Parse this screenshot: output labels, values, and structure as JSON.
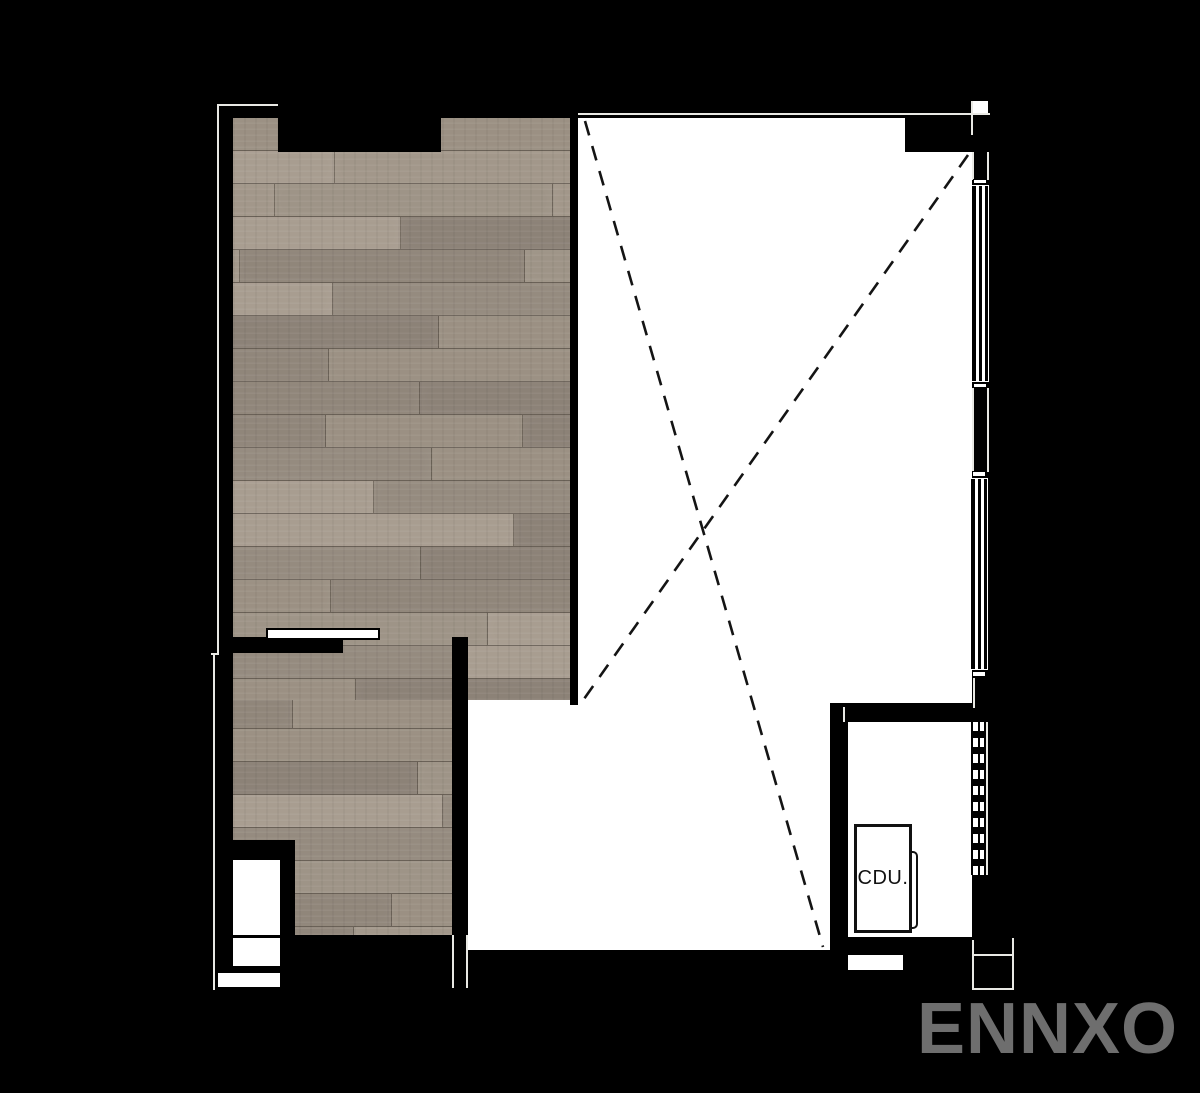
{
  "plan": {
    "cdu_label": "CDU.",
    "watermark": "ENNXO"
  },
  "colors": {
    "background": "#000000",
    "floor_white": "#ffffff",
    "outline": "#e9e9e4",
    "dash_line": "#141414",
    "watermark": "#6e6e6e",
    "wood_palette": [
      "#9b9083",
      "#a2978a",
      "#90867a",
      "#a89d90",
      "#958b7f",
      "#9e9487",
      "#8c8277"
    ],
    "plank_joint": "rgba(58,50,43,0.5)"
  }
}
